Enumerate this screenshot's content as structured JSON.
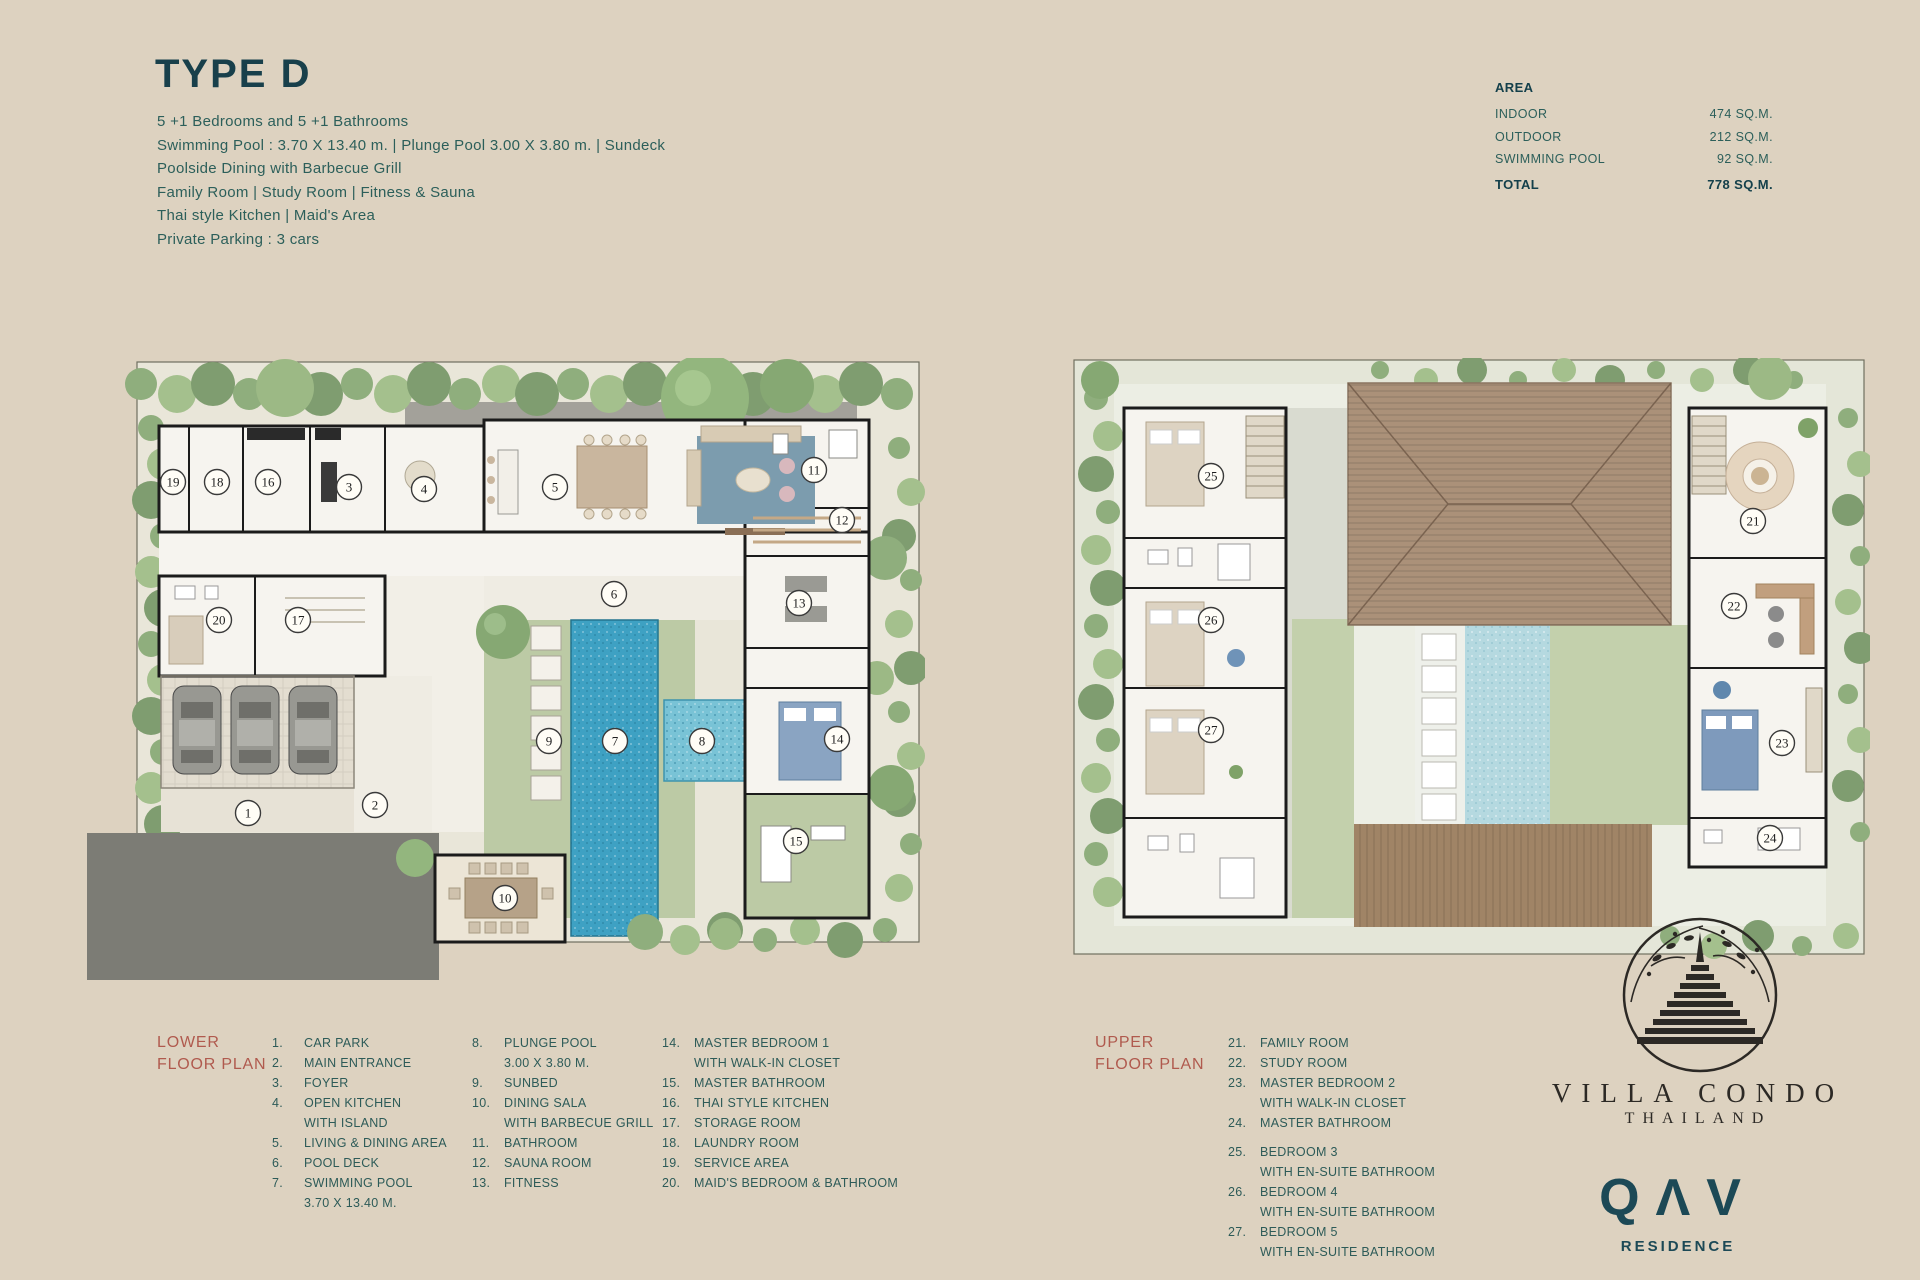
{
  "header": {
    "title": "TYPE D",
    "description_lines": [
      "5 +1 Bedrooms and 5 +1 Bathrooms",
      "Swimming Pool : 3.70 X 13.40 m.  |  Plunge Pool 3.00 X 3.80 m.  |  Sundeck",
      "Poolside Dining with Barbecue Grill",
      "Family Room  |  Study Room  |  Fitness & Sauna",
      "Thai style Kitchen  |  Maid's Area",
      "Private Parking : 3 cars"
    ]
  },
  "area_table": {
    "title": "AREA",
    "rows": [
      {
        "label": "INDOOR",
        "value": "474 SQ.M."
      },
      {
        "label": "OUTDOOR",
        "value": "212 SQ.M."
      },
      {
        "label": "SWIMMING POOL",
        "value": "92 SQ.M."
      }
    ],
    "total": {
      "label": "TOTAL",
      "value": "778 SQ.M."
    }
  },
  "legends": {
    "lower": {
      "title_line1": "LOWER",
      "title_line2": "FLOOR PLAN",
      "columns": [
        [
          {
            "n": "1.",
            "lines": [
              "CAR PARK"
            ]
          },
          {
            "n": "2.",
            "lines": [
              "MAIN ENTRANCE"
            ]
          },
          {
            "n": "3.",
            "lines": [
              "FOYER"
            ]
          },
          {
            "n": "4.",
            "lines": [
              "OPEN KITCHEN",
              "WITH ISLAND"
            ]
          },
          {
            "n": "5.",
            "lines": [
              "LIVING & DINING AREA"
            ]
          },
          {
            "n": "6.",
            "lines": [
              "POOL DECK"
            ]
          },
          {
            "n": "7.",
            "lines": [
              "SWIMMING POOL",
              "3.70 X 13.40 M."
            ]
          }
        ],
        [
          {
            "n": "8.",
            "lines": [
              "PLUNGE POOL",
              "3.00 X 3.80 M."
            ]
          },
          {
            "n": "9.",
            "lines": [
              "SUNBED"
            ]
          },
          {
            "n": "10.",
            "lines": [
              "DINING SALA",
              "WITH BARBECUE GRILL"
            ]
          },
          {
            "n": "11.",
            "lines": [
              "BATHROOM"
            ]
          },
          {
            "n": "12.",
            "lines": [
              "SAUNA ROOM"
            ]
          },
          {
            "n": "13.",
            "lines": [
              "FITNESS"
            ]
          }
        ],
        [
          {
            "n": "14.",
            "lines": [
              "MASTER BEDROOM 1",
              "WITH WALK-IN CLOSET"
            ]
          },
          {
            "n": "15.",
            "lines": [
              "MASTER BATHROOM"
            ]
          },
          {
            "n": "16.",
            "lines": [
              "THAI STYLE KITCHEN"
            ]
          },
          {
            "n": "17.",
            "lines": [
              "STORAGE ROOM"
            ]
          },
          {
            "n": "18.",
            "lines": [
              "LAUNDRY ROOM"
            ]
          },
          {
            "n": "19.",
            "lines": [
              "SERVICE AREA"
            ]
          },
          {
            "n": "20.",
            "lines": [
              "MAID'S BEDROOM & BATHROOM"
            ]
          }
        ]
      ]
    },
    "upper": {
      "title_line1": "UPPER",
      "title_line2": "FLOOR PLAN",
      "columns": [
        [
          {
            "n": "21.",
            "lines": [
              "FAMILY ROOM"
            ]
          },
          {
            "n": "22.",
            "lines": [
              "STUDY ROOM"
            ]
          },
          {
            "n": "23.",
            "lines": [
              "MASTER BEDROOM 2",
              "WITH WALK-IN CLOSET"
            ]
          },
          {
            "n": "24.",
            "lines": [
              "MASTER BATHROOM"
            ]
          },
          {
            "n": "25.",
            "lines": [
              "BEDROOM 3",
              "WITH EN-SUITE BATHROOM"
            ],
            "gap": true
          },
          {
            "n": "26.",
            "lines": [
              "BEDROOM 4",
              "WITH EN-SUITE BATHROOM"
            ]
          },
          {
            "n": "27.",
            "lines": [
              "BEDROOM 5",
              "WITH EN-SUITE BATHROOM"
            ]
          }
        ]
      ]
    }
  },
  "plans": {
    "lower": {
      "markers": [
        {
          "n": "19",
          "x": 88,
          "y": 124
        },
        {
          "n": "18",
          "x": 132,
          "y": 124
        },
        {
          "n": "16",
          "x": 183,
          "y": 124
        },
        {
          "n": "3",
          "x": 264,
          "y": 129
        },
        {
          "n": "4",
          "x": 339,
          "y": 131
        },
        {
          "n": "5",
          "x": 470,
          "y": 129
        },
        {
          "n": "11",
          "x": 729,
          "y": 112
        },
        {
          "n": "12",
          "x": 757,
          "y": 162
        },
        {
          "n": "6",
          "x": 529,
          "y": 236
        },
        {
          "n": "13",
          "x": 714,
          "y": 245
        },
        {
          "n": "20",
          "x": 134,
          "y": 262
        },
        {
          "n": "17",
          "x": 213,
          "y": 262
        },
        {
          "n": "9",
          "x": 464,
          "y": 383
        },
        {
          "n": "7",
          "x": 530,
          "y": 383
        },
        {
          "n": "8",
          "x": 617,
          "y": 383
        },
        {
          "n": "14",
          "x": 752,
          "y": 381
        },
        {
          "n": "1",
          "x": 163,
          "y": 455
        },
        {
          "n": "2",
          "x": 290,
          "y": 447
        },
        {
          "n": "15",
          "x": 711,
          "y": 483
        },
        {
          "n": "10",
          "x": 420,
          "y": 540
        }
      ]
    },
    "upper": {
      "markers": [
        {
          "n": "25",
          "x": 141,
          "y": 118
        },
        {
          "n": "26",
          "x": 141,
          "y": 262
        },
        {
          "n": "27",
          "x": 141,
          "y": 372
        },
        {
          "n": "21",
          "x": 683,
          "y": 163
        },
        {
          "n": "22",
          "x": 664,
          "y": 248
        },
        {
          "n": "23",
          "x": 712,
          "y": 385
        },
        {
          "n": "24",
          "x": 700,
          "y": 480
        }
      ]
    }
  },
  "logo": {
    "name": "VILLA CONDO",
    "country": "THAILAND",
    "brand": "QΛV",
    "brand_sub": "RESIDENCE"
  },
  "colors": {
    "accent_teal": "#2c5f5a",
    "accent_red": "#b05a4e",
    "pool_blue": "#3ea1c3",
    "hedge_green": "#8fae7d",
    "roof_brown": "#ab9179"
  }
}
